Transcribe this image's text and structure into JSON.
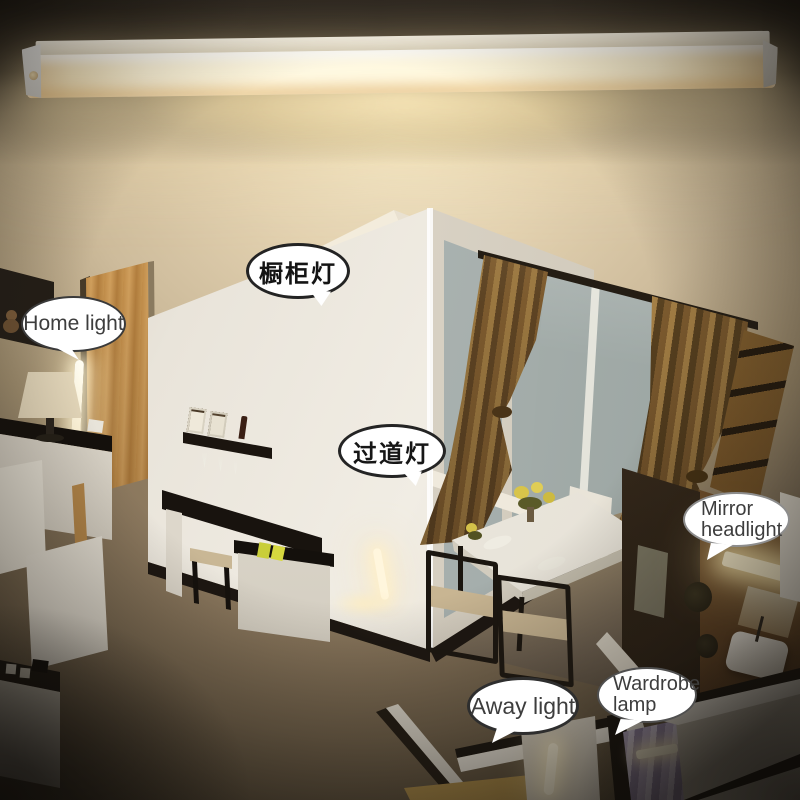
{
  "callouts": {
    "cabinet": {
      "label": "橱柜灯"
    },
    "home": {
      "label": "Home light"
    },
    "aisle": {
      "label": "过道灯"
    },
    "mirror": {
      "line1": "Mirror",
      "line2": "headlight"
    },
    "away": {
      "label": "Away light"
    },
    "wardrobe": {
      "line1": "Wardrobe",
      "line2": "lamp"
    }
  },
  "colors": {
    "bubble_fill": "#ffffff",
    "bubble_border_dark": "#262626",
    "bubble_border_light": "#8d8d8d",
    "bubble_text_cn": "#141414",
    "bubble_text_en": "#3d3d3d",
    "led_glow": "#fff6dc",
    "warm_wall": "#e4d3b2",
    "background_dark": "#2f2921",
    "curtain_bronze": "#7c5a2e",
    "door_oak": "#c08c49",
    "window_gray": "#aab3b0",
    "floor_tan": "#9b8768",
    "books_yellow": "#c9ce3a",
    "clothes_lilac": "#b3a6c4"
  }
}
